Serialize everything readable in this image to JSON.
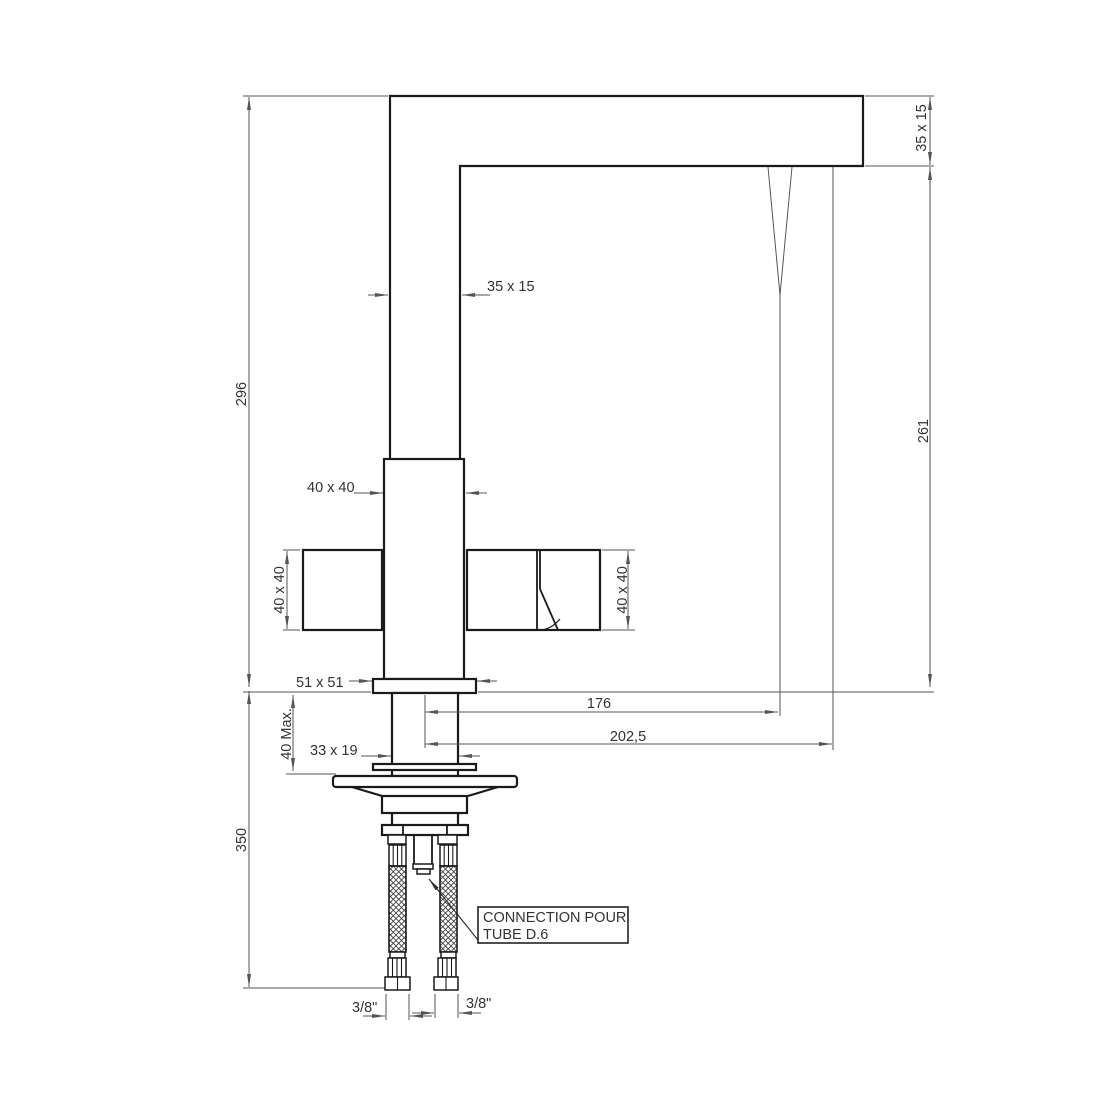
{
  "drawing": {
    "background": "#ffffff",
    "line_colors": {
      "object": "#1a1a1a",
      "dimension": "#555555",
      "text": "#333333"
    },
    "dimensions": {
      "overall_height": "296",
      "hose_length": "350",
      "max_deck_thickness": "40 Max.",
      "body_section": "40 x 40",
      "handle_left_section": "40 x 40",
      "handle_right_section": "40 x 40",
      "column_section": "35 x 15",
      "spout_section": "35 x 15",
      "base_plate_section": "51 x 51",
      "shank_section": "33 x 19",
      "reach_to_aerator": "176",
      "reach_overall": "202,5",
      "spout_to_deck_height": "261",
      "thread_left": "3/8\"",
      "thread_right": "3/8\""
    },
    "callout": {
      "line1": "CONNECTION POUR",
      "line2": "TUBE D.6"
    }
  }
}
